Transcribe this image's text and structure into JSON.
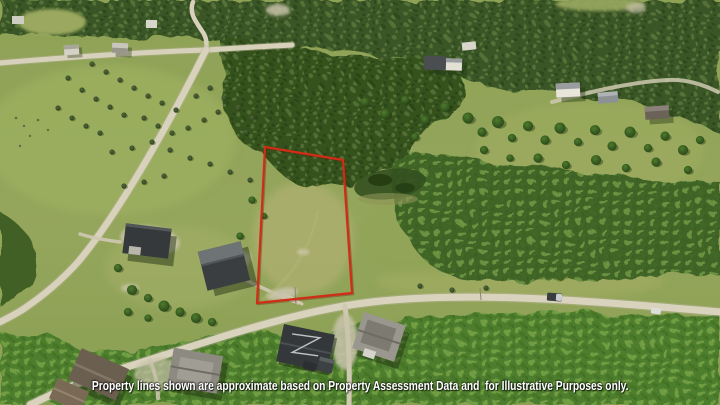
{
  "photo": {
    "kind": "aerial-drone-photo",
    "subject": "rural acreage lot outlined in red"
  },
  "disclaimer": {
    "text": "Property lines shown are approximate based on Property Assessment Data and  for Illustrative Purposes only."
  },
  "colors": {
    "property_line": "#cf2d16",
    "disclaimer_text": "#ffffff"
  }
}
